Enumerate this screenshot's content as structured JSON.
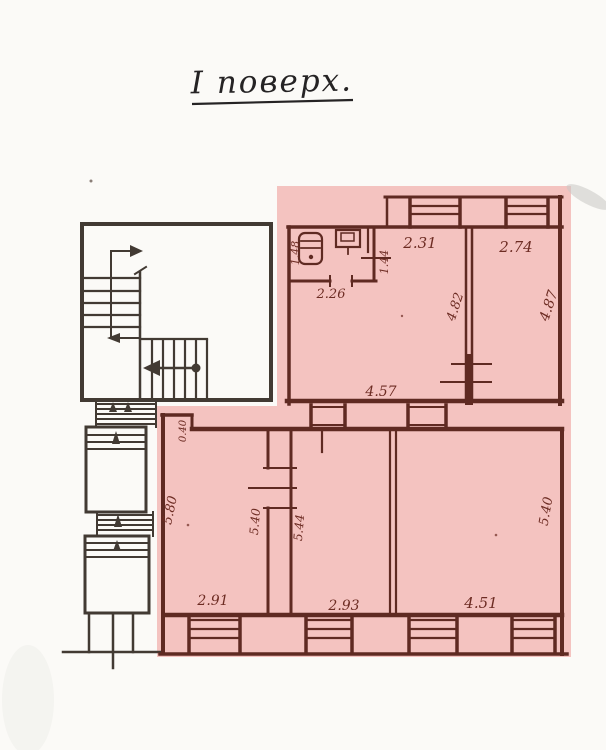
{
  "page": {
    "title": "І поверх."
  },
  "colors": {
    "highlight_pink": "#f4c3c0",
    "wall_ink_dark": "#423a33",
    "wall_ink_maroon": "#5f2a22",
    "dimension_ink": "#6d2c23",
    "paper": "#fbfaf7"
  },
  "dims": {
    "bath_width": "1.48",
    "bath_length": "2.26",
    "bath_side": "1.44",
    "room_top_left_width": "2.31",
    "room_top_right_width": "2.74",
    "room_top_left_depth": "4.82",
    "room_top_right_depth": "4.87",
    "hall_width": "4.57",
    "notch_depth": "0.40",
    "room_left_depth": "5.80",
    "room_left_depth_right": "5.40",
    "room_mid_depth": "5.44",
    "room_right_depth": "5.40",
    "room_left_width": "2.91",
    "room_mid_width": "2.93",
    "room_right_width": "4.51"
  }
}
